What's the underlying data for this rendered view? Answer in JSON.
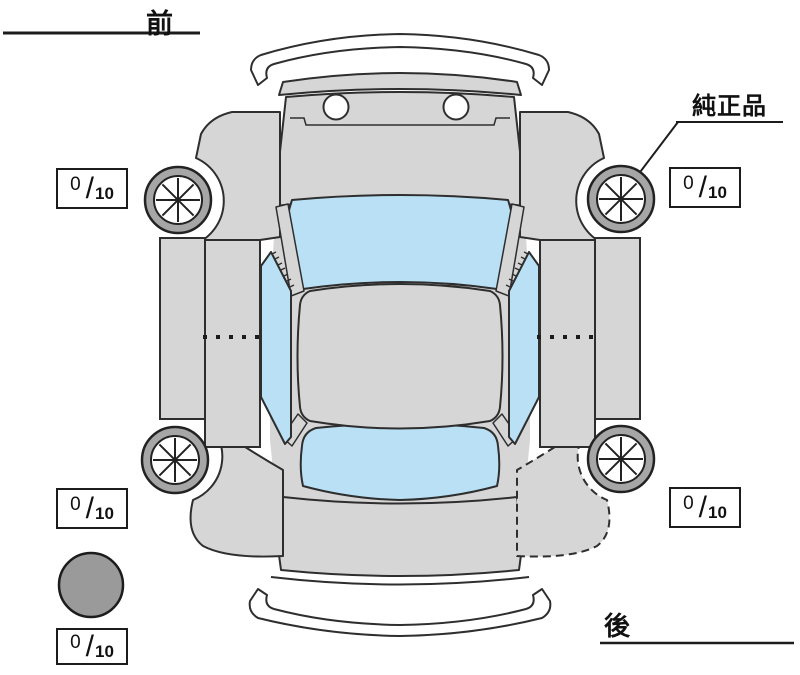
{
  "diagram": {
    "type": "vehicle-condition-top-view",
    "labels": {
      "front": "前",
      "rear": "後",
      "genuine_part": "純正品"
    },
    "fraction_slash": "/",
    "tread": {
      "front_left": {
        "value": "0",
        "max": "10"
      },
      "front_right": {
        "value": "0",
        "max": "10"
      },
      "rear_left": {
        "value": "0",
        "max": "10"
      },
      "rear_right": {
        "value": "0",
        "max": "10"
      },
      "spare": {
        "value": "0",
        "max": "10"
      }
    },
    "colors": {
      "body": "#d6d6d6",
      "glass": "#b9e0f4",
      "bumper": "#ffffff",
      "tire_ring": "#a6a6a6",
      "wheel_face": "#ffffff",
      "spare_tire": "#9a9a9a",
      "outline": "#2e2e2e"
    }
  }
}
